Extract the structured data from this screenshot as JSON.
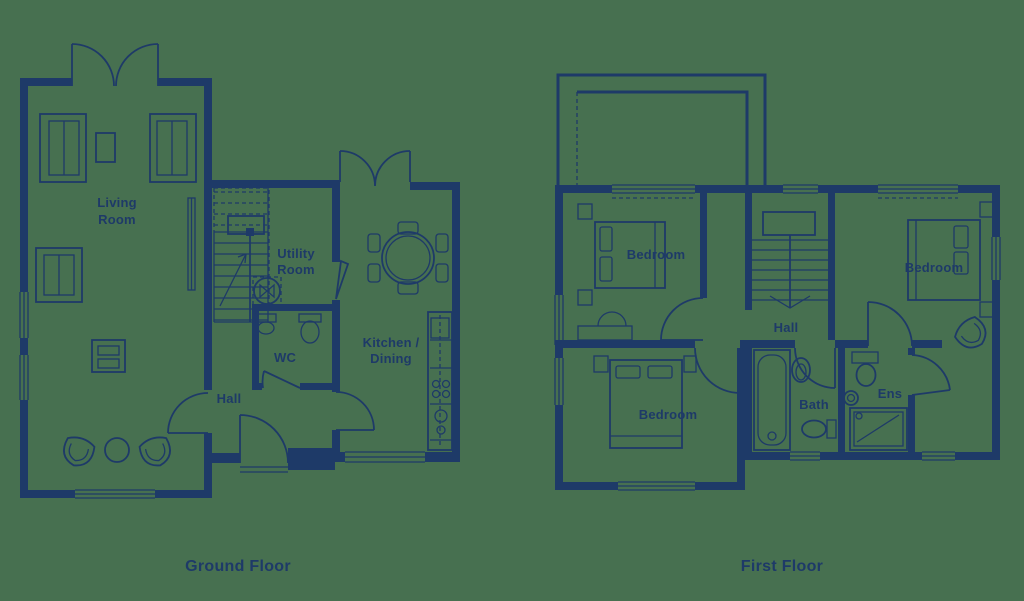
{
  "colors": {
    "background": "#477050",
    "ink": "#1E3A68"
  },
  "ground_floor": {
    "title": "Ground Floor",
    "labels": {
      "living_room_line1": "Living",
      "living_room_line2": "Room",
      "utility_line1": "Utility",
      "utility_line2": "Room",
      "wc": "WC",
      "hall": "Hall",
      "kitchen_line1": "Kitchen /",
      "kitchen_line2": "Dining"
    }
  },
  "first_floor": {
    "title": "First Floor",
    "labels": {
      "bedroom_top_left": "Bedroom",
      "bedroom_right": "Bedroom",
      "bedroom_bottom_left": "Bedroom",
      "hall": "Hall",
      "bath": "Bath",
      "ensuite": "Ens"
    }
  }
}
